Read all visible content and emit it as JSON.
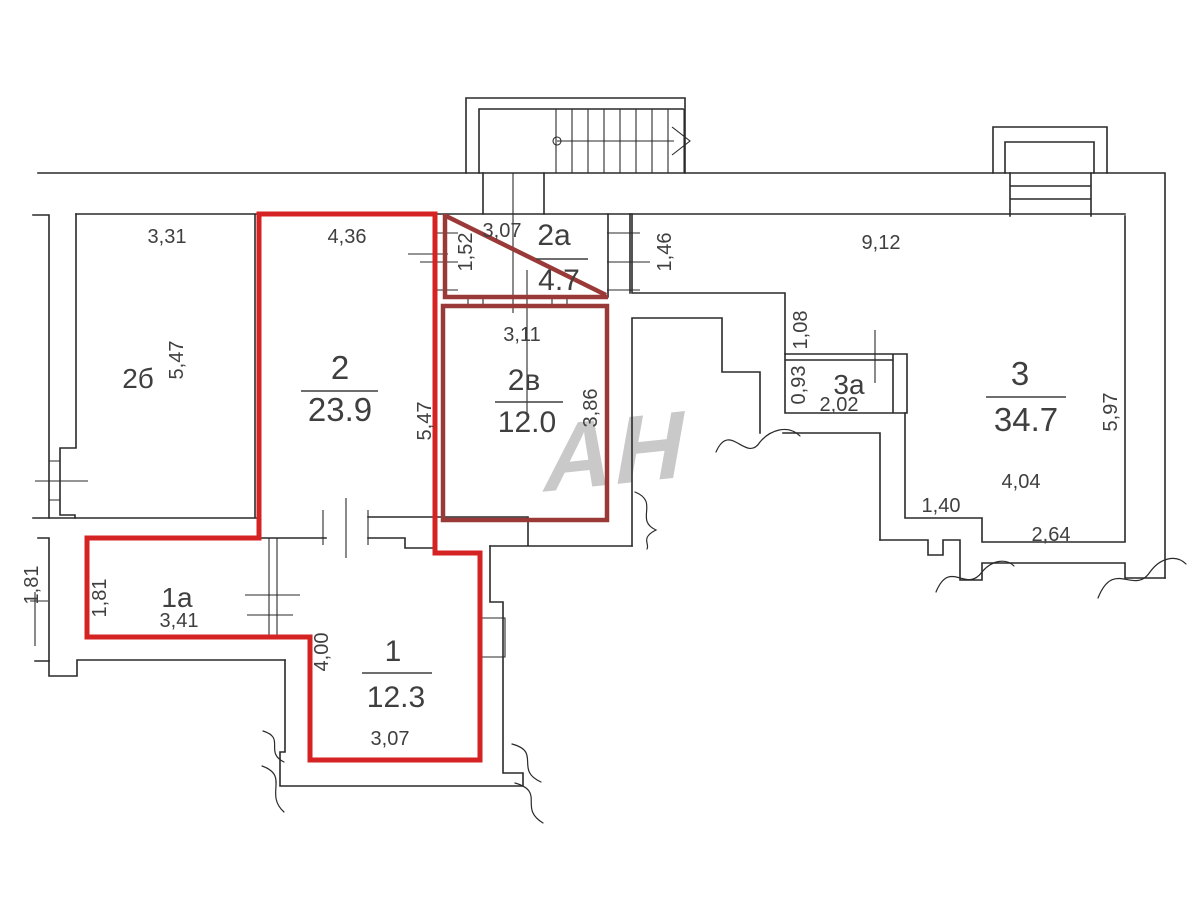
{
  "watermark_text": "АН",
  "colors": {
    "wall": "#2a2a2a",
    "unit_outline": "#d42322",
    "room_outline": "#9a3a38",
    "text": "#3f3f3f",
    "watermark": "#c9c9c9"
  },
  "rooms": {
    "room_2b": {
      "label": "2б",
      "dim_top": "3,31",
      "dim_height": "5,47"
    },
    "room_2": {
      "number": "2",
      "area": "23.9",
      "dim_top": "4,36",
      "dim_height": "5,47"
    },
    "room_2a": {
      "label": "2а",
      "area": "4.7",
      "dim_top": "3,07",
      "dim_left": "1,52"
    },
    "room_2v": {
      "label": "2в",
      "area": "12.0",
      "dim_top": "3,11",
      "dim_right": "3,86"
    },
    "room_3": {
      "number": "3",
      "area": "34.7",
      "dim_top": "9,12",
      "dim_right": "5,97",
      "dim_width": "4,04",
      "dim_step": "1,40",
      "dim_bottom": "2,64"
    },
    "room_3a": {
      "label": "3а",
      "dim_width": "2,02",
      "dim_height": "0,93",
      "dim_above": "1,08"
    },
    "room_1a": {
      "label": "1а",
      "dim_width": "3,41",
      "dim_height": "1,81"
    },
    "room_1": {
      "number": "1",
      "area": "12.3",
      "dim_height": "4,00",
      "dim_bottom": "3,07"
    },
    "corridor": {
      "dim_door": "1,46"
    },
    "exterior": {
      "dim_left": "1,81"
    }
  }
}
